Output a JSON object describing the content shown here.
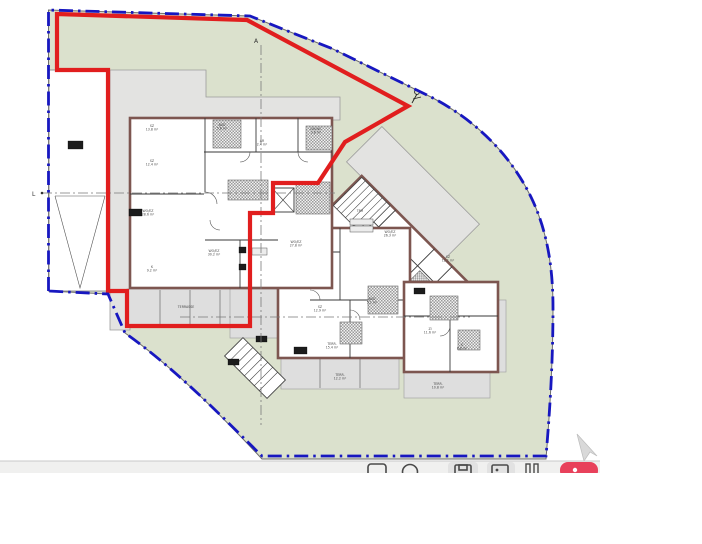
{
  "app": {
    "description": "architectural site and floor plan drawing"
  },
  "colors": {
    "site_boundary_blue": "#1717c0",
    "highlight_red": "#e11e1e",
    "lawn_green": "#dbe1cd",
    "building_gray": "#e3e3e1",
    "wall_brown": "#7d5650",
    "record_button_red": "#e8415b"
  },
  "markers": {
    "axis_top_letter": "A",
    "axis_left_letter": "L"
  },
  "plan": {
    "room_labels": [
      {
        "x": 152,
        "y": 127,
        "t1": "SZ",
        "t2": "13.8 m²"
      },
      {
        "x": 152,
        "y": 162,
        "t1": "SZ",
        "t2": "12.4 m²"
      },
      {
        "x": 148,
        "y": 212,
        "t1": "WO/EZ",
        "t2": "28.6 m²"
      },
      {
        "x": 152,
        "y": 268,
        "t1": "K",
        "t2": "9.2 m²"
      },
      {
        "x": 222,
        "y": 126,
        "t1": "BAD",
        "t2": "5.6 m²"
      },
      {
        "x": 316,
        "y": 130,
        "t1": "DU/WC",
        "t2": "3.8 m²"
      },
      {
        "x": 262,
        "y": 142,
        "t1": "AR",
        "t2": "2.4 m²"
      },
      {
        "x": 214,
        "y": 252,
        "t1": "WO/EZ",
        "t2": "30.2 m²"
      },
      {
        "x": 296,
        "y": 243,
        "t1": "WO/EZ",
        "t2": "27.8 m²"
      },
      {
        "x": 320,
        "y": 308,
        "t1": "SZ",
        "t2": "12.9 m²"
      },
      {
        "x": 332,
        "y": 345,
        "t1": "TERR.",
        "t2": "15.4 m²"
      },
      {
        "x": 390,
        "y": 233,
        "t1": "WO/EZ",
        "t2": "26.3 m²"
      },
      {
        "x": 448,
        "y": 258,
        "t1": "SZ",
        "t2": "12.1 m²"
      },
      {
        "x": 372,
        "y": 300,
        "t1": "BAD",
        "t2": "5.1 m²"
      },
      {
        "x": 430,
        "y": 330,
        "t1": "ZI",
        "t2": "11.6 m²"
      },
      {
        "x": 462,
        "y": 346,
        "t1": "K",
        "t2": "8.8 m²"
      },
      {
        "x": 340,
        "y": 376,
        "t1": "TERR.",
        "t2": "12.2 m²"
      },
      {
        "x": 438,
        "y": 385,
        "t1": "TERR.",
        "t2": "10.8 m²"
      },
      {
        "x": 186,
        "y": 308,
        "t1": "TERRASSE",
        "t2": ""
      },
      {
        "x": 360,
        "y": 212,
        "t1": "TRH",
        "t2": ""
      }
    ],
    "tag_boxes": [
      {
        "x": 68,
        "y": 141,
        "w": 15,
        "h": 8,
        "style": "dark",
        "t": ""
      },
      {
        "x": 129,
        "y": 209,
        "w": 13,
        "h": 7,
        "style": "dark",
        "t": ""
      },
      {
        "x": 294,
        "y": 347,
        "w": 13,
        "h": 7,
        "style": "dark",
        "t": ""
      },
      {
        "x": 256,
        "y": 336,
        "w": 11,
        "h": 6,
        "style": "dark",
        "t": ""
      },
      {
        "x": 228,
        "y": 359,
        "w": 11,
        "h": 6,
        "style": "dark",
        "t": ""
      },
      {
        "x": 414,
        "y": 288,
        "w": 11,
        "h": 6,
        "style": "dark",
        "t": ""
      },
      {
        "x": 350,
        "y": 219,
        "w": 23,
        "h": 6,
        "style": "light",
        "t": ""
      },
      {
        "x": 350,
        "y": 226,
        "w": 23,
        "h": 6,
        "style": "light",
        "t": ""
      },
      {
        "x": 252,
        "y": 248,
        "w": 15,
        "h": 7,
        "style": "light",
        "t": ""
      },
      {
        "x": 239,
        "y": 247,
        "w": 7,
        "h": 6,
        "style": "dark",
        "t": ""
      },
      {
        "x": 239,
        "y": 264,
        "w": 7,
        "h": 6,
        "style": "dark",
        "t": ""
      }
    ]
  },
  "toolbar": {
    "icons": [
      {
        "name": "window-icon"
      },
      {
        "name": "clock-icon"
      },
      {
        "name": "save-icon"
      },
      {
        "name": "image-icon"
      },
      {
        "name": "pause-icon"
      },
      {
        "name": "record-button"
      }
    ]
  }
}
